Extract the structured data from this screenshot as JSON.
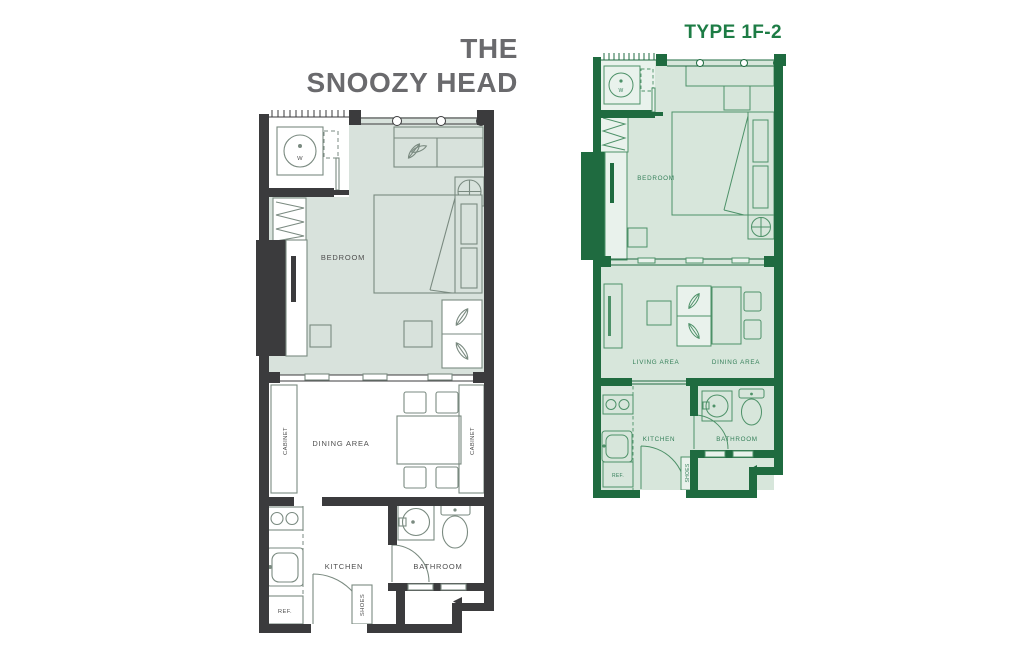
{
  "titles": {
    "left_line1": "THE",
    "left_line2": "SNOOZY HEAD",
    "right": "TYPE 1F-2"
  },
  "left_plan": {
    "labels": {
      "washer": "W",
      "bedroom": "BEDROOM",
      "dining_area": "DINING AREA",
      "cabinet_left": "CABINET",
      "cabinet_right": "CABINET",
      "kitchen": "KITCHEN",
      "bathroom": "BATHROOM",
      "shoes": "SHOES",
      "fridge": "REF."
    }
  },
  "right_plan": {
    "labels": {
      "washer": "W",
      "bedroom": "BEDROOM",
      "living_area": "LIVING AREA",
      "dining_area": "DINING AREA",
      "kitchen": "KITCHEN",
      "bathroom": "BATHROOM",
      "shoes": "SHOES",
      "fridge": "REF."
    }
  },
  "colors": {
    "left_wall": "#3b3b3d",
    "left_furniture": "#7a8a80",
    "left_floor": "#d8e2dc",
    "left_label": "#4f4f4f",
    "left_title": "#6a6a6d",
    "right_wall": "#1f6b40",
    "right_furniture": "#4d9168",
    "right_floor": "#d7e6db",
    "right_balcony": "#e9f2ec",
    "right_label": "#35805a",
    "right_title": "#1d7c45"
  }
}
